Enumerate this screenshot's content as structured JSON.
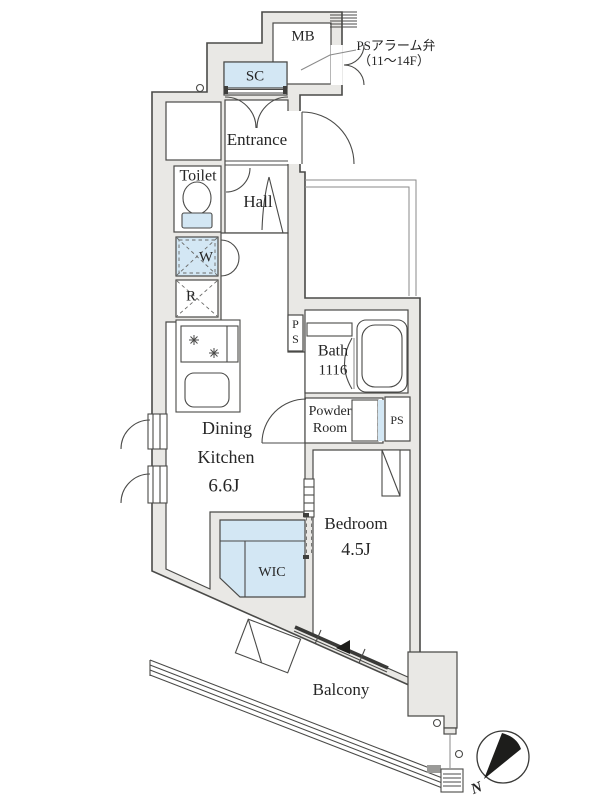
{
  "plan": {
    "rooms": {
      "mb": "MB",
      "sc": "SC",
      "entrance": "Entrance",
      "toilet": "Toilet",
      "hall": "Hall",
      "washer": "W",
      "refrigerator": "R",
      "ps_top_p": "P",
      "ps_top_s": "S",
      "bath_name": "Bath",
      "bath_size": "1116",
      "powder_line1": "Powder",
      "powder_line2": "Room",
      "ps_side": "PS",
      "dk_line1": "Dining",
      "dk_line2": "Kitchen",
      "dk_size": "6.6J",
      "bedroom_name": "Bedroom",
      "bedroom_size": "4.5J",
      "wic": "WIC",
      "balcony": "Balcony"
    },
    "annotations": {
      "ps_alarm_line1": "PSアラーム弁",
      "ps_alarm_line2": "（11〜14F）",
      "compass_north": "N"
    },
    "colors": {
      "wall": "#e9e8e5",
      "line": "#4a4a48",
      "closet_blue": "#d3e7f4",
      "text": "#262626"
    }
  }
}
